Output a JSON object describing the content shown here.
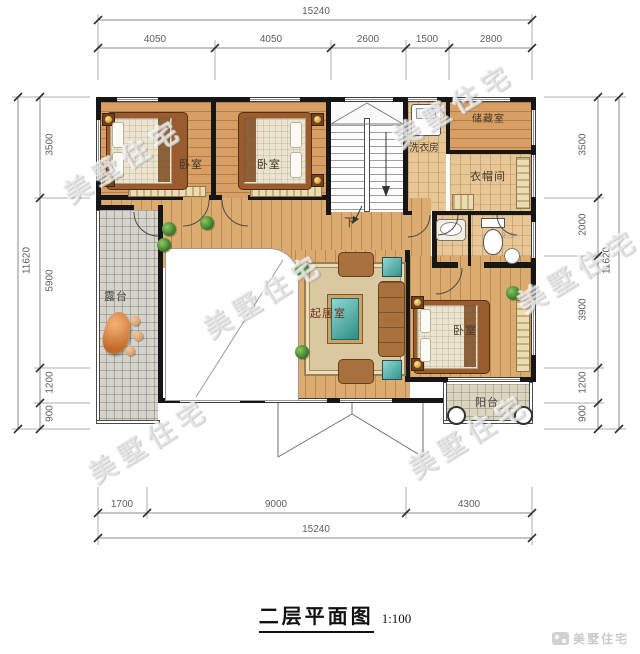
{
  "title": {
    "text": "二层平面图",
    "scale": "1:100"
  },
  "brand": {
    "watermark": "美墅住宅",
    "footer": "美墅住宅"
  },
  "dimensions": {
    "top": {
      "overall": "15240",
      "segments": [
        "4050",
        "4050",
        "2600",
        "1500",
        "2800"
      ]
    },
    "bottom": {
      "overall": "15240",
      "segments": [
        "1700",
        "9000",
        "4300"
      ]
    },
    "left": {
      "overall": "11620",
      "segments": [
        "3500",
        "5900",
        "1200",
        "900"
      ]
    },
    "right": {
      "overall": "11620",
      "segments": [
        "3500",
        "2000",
        "3900",
        "1200",
        "900"
      ]
    }
  },
  "rooms": {
    "bedroom": "卧室",
    "laundry": "洗衣房",
    "storage": "储藏室",
    "cloakroom": "衣帽间",
    "living": "起居室",
    "terrace": "露台",
    "balcony": "阳台",
    "stairs_down": "下",
    "bath_note": "2.3"
  }
}
